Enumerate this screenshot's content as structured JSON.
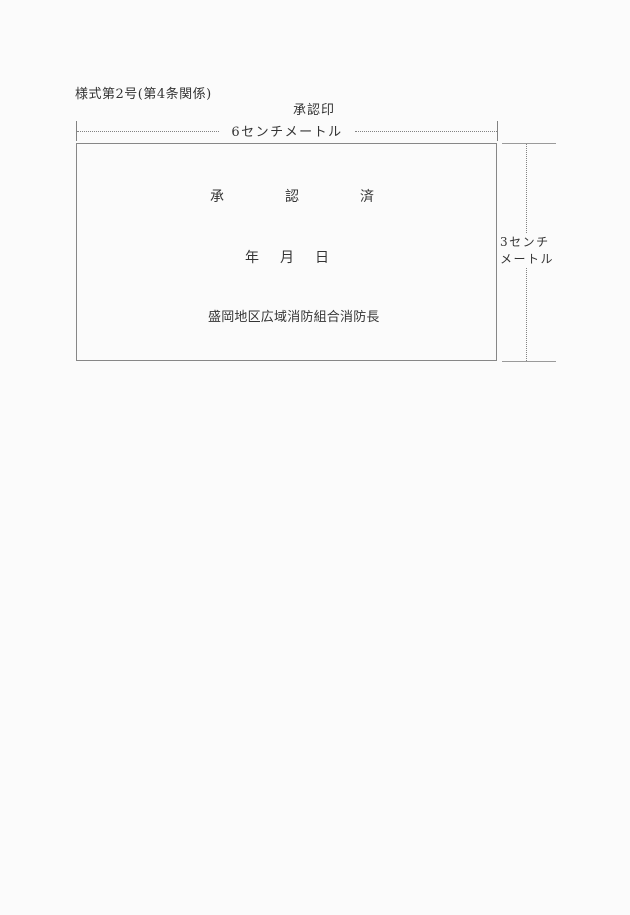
{
  "document": {
    "form_label": "様式第2号(第4条関係)",
    "stamp_caption": "承認印"
  },
  "measurements": {
    "width_label": "6センチメートル",
    "height_label_lines": [
      "3センチ",
      "メートル"
    ]
  },
  "stamp": {
    "approval_chars": [
      "承",
      "認",
      "済"
    ],
    "date_chars": [
      "年",
      "月",
      "日"
    ],
    "organization": "盛岡地区広域消防組合消防長"
  },
  "colors": {
    "background": "#fbfbfb",
    "line": "#828282",
    "text": "#343434"
  }
}
